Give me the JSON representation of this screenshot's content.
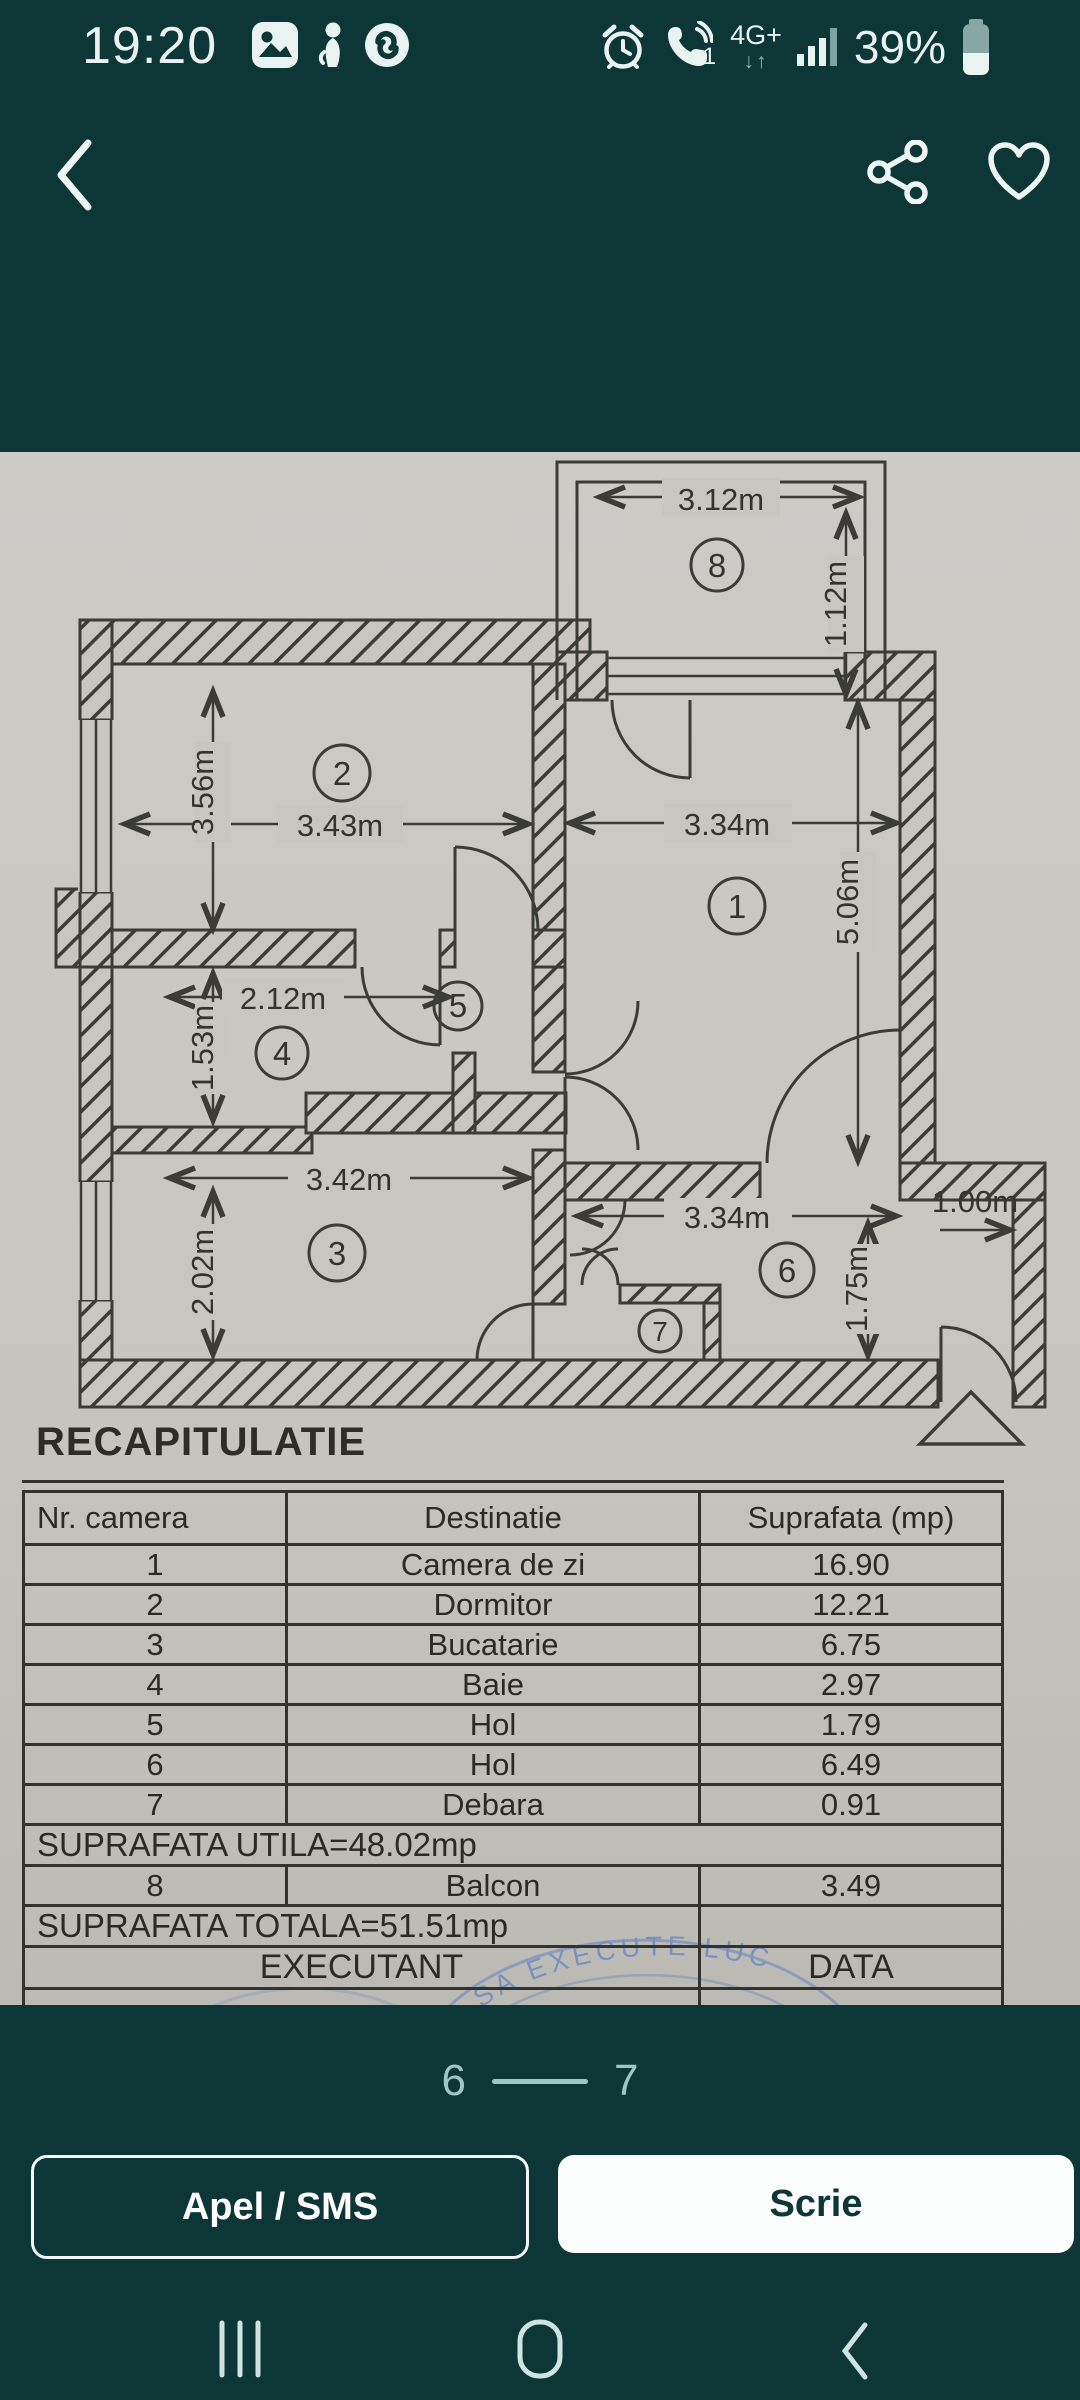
{
  "status_bar": {
    "time": "19:20",
    "call_count": "1",
    "network": "4G+",
    "network_arrows": "↓↑",
    "battery_percent": "39%"
  },
  "photo": {
    "plan": {
      "dims": {
        "balcony_width": "3.12m",
        "balcony_depth": "1.12m",
        "room2_height": "3.56m",
        "room2_width": "3.43m",
        "room1_width": "3.34m",
        "room1_height": "5.06m",
        "bath_width": "2.12m",
        "bath_height": "1.53m",
        "kitchen_width": "3.42m",
        "kitchen_height": "2.02m",
        "hall_width": "3.34m",
        "hall_height": "1.75m",
        "entry_width": "1.00m"
      },
      "room_numbers": [
        "1",
        "2",
        "3",
        "4",
        "5",
        "6",
        "7",
        "8"
      ]
    },
    "recap": {
      "title": "RECAPITULATIE",
      "table": {
        "headers": [
          "Nr. camera",
          "Destinatie",
          "Suprafata (mp)"
        ],
        "rows": [
          [
            "1",
            "Camera de zi",
            "16.90"
          ],
          [
            "2",
            "Dormitor",
            "12.21"
          ],
          [
            "3",
            "Bucatarie",
            "6.75"
          ],
          [
            "4",
            "Baie",
            "2.97"
          ],
          [
            "5",
            "Hol",
            "1.79"
          ],
          [
            "6",
            "Hol",
            "6.49"
          ],
          [
            "7",
            "Debara",
            "0.91"
          ]
        ],
        "utila": "SUPRAFATA UTILA=48.02mp",
        "balcony_row": [
          "8",
          "Balcon",
          "3.49"
        ],
        "totala": "SUPRAFATA TOTALA=51.51mp",
        "executant": "EXECUTANT",
        "data_label": "DATA"
      },
      "stamp_text": "SA EXECUTE LUC"
    }
  },
  "pagination": {
    "current": "6",
    "next": "7"
  },
  "actions": {
    "call_sms": "Apel / SMS",
    "write": "Scrie"
  },
  "colors": {
    "background": "#0d3637",
    "paper": "#c9c6c1",
    "ink": "#33332f",
    "accent_light": "#cfe3e0",
    "pagination": "#9ec7c3",
    "stamp_blue": "#6b87c0"
  }
}
